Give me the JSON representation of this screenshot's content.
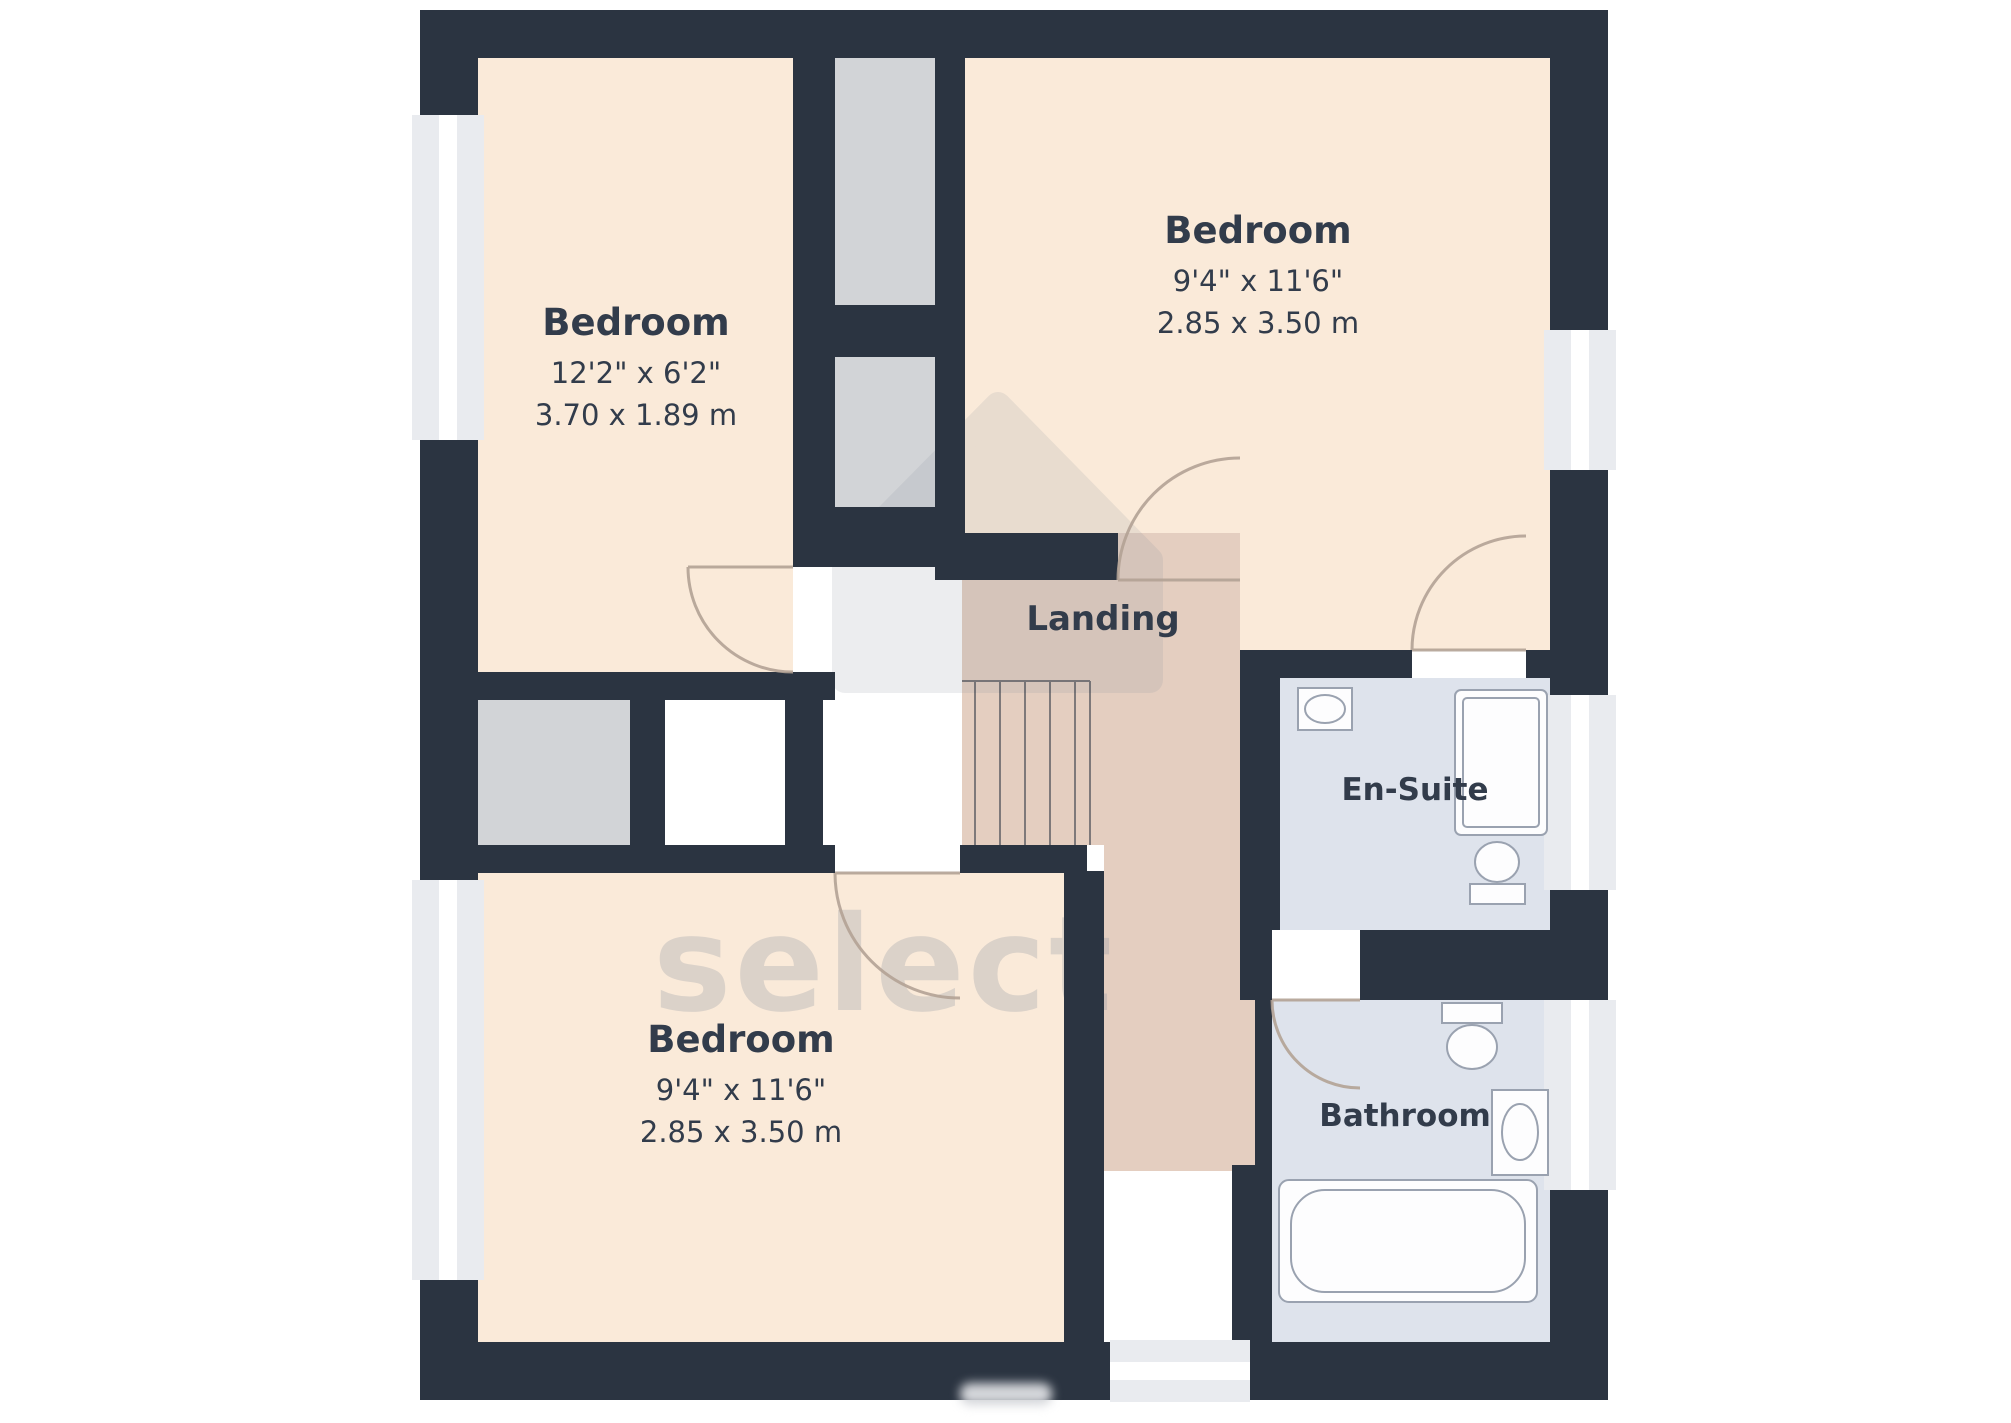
{
  "plan_title": "Floor plan - first floor",
  "rooms": {
    "bedroom_tl": {
      "name": "Bedroom",
      "size_ft": "12'2\" x 6'2\"",
      "size_m": "3.70 x 1.89 m"
    },
    "bedroom_tr": {
      "name": "Bedroom",
      "size_ft": "9'4\" x 11'6\"",
      "size_m": "2.85 x 3.50 m"
    },
    "bedroom_bottom": {
      "name": "Bedroom",
      "size_ft": "9'4\" x 11'6\"",
      "size_m": "2.85 x 3.50 m"
    },
    "landing": {
      "name": "Landing"
    },
    "ensuite": {
      "name": "En-Suite"
    },
    "bathroom": {
      "name": "Bathroom"
    }
  },
  "watermark": {
    "text": "select"
  },
  "colors": {
    "wall": "#2b3441",
    "bedroom_floor": "#faead9",
    "landing_floor": "#e4cec0",
    "wet_room_floor": "#dee3ec",
    "closet": "#d2d4d7",
    "window": "#e9ebef",
    "white": "#ffffff",
    "text": "#323c4b",
    "door": "#b3a295",
    "fixture": "#9aa2b0",
    "watermark_gray": "#8e95a1"
  }
}
